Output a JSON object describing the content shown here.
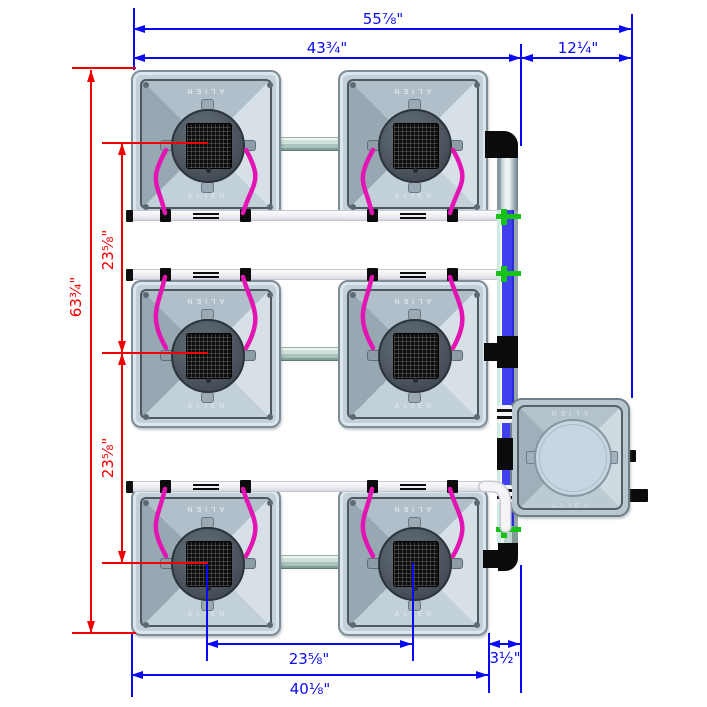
{
  "labels": {
    "brand": "ALIEN"
  },
  "colors": {
    "dimension_blue": "#0a0af2",
    "dimension_red": "#f20000",
    "hose_magenta": "#e215b2",
    "pipe_water_blue": "#4040f0",
    "fitting_green": "#17c317",
    "pipe_white": "#f4f4f7",
    "bucket_body": "#c2d0d9"
  },
  "buckets": [
    {
      "id": 1,
      "x": 131,
      "y": 70,
      "hose_dir": "down",
      "hose_pipe_y": 213
    },
    {
      "id": 2,
      "x": 338,
      "y": 70,
      "hose_dir": "down",
      "hose_pipe_y": 213
    },
    {
      "id": 3,
      "x": 131,
      "y": 280,
      "hose_dir": "up",
      "hose_pipe_y": 277
    },
    {
      "id": 4,
      "x": 338,
      "y": 280,
      "hose_dir": "up",
      "hose_pipe_y": 277
    },
    {
      "id": 5,
      "x": 131,
      "y": 488,
      "hose_dir": "up",
      "hose_pipe_y": 489
    },
    {
      "id": 6,
      "x": 338,
      "y": 488,
      "hose_dir": "up",
      "hose_pipe_y": 489
    }
  ],
  "connectors": [
    {
      "x": 275,
      "y": 137
    },
    {
      "x": 275,
      "y": 347
    },
    {
      "x": 275,
      "y": 555
    }
  ],
  "white_pipes": [
    {
      "y": 210,
      "x1": 127,
      "x2": 505,
      "centers": [
        206,
        413
      ],
      "curve": false
    },
    {
      "y": 269,
      "x1": 127,
      "x2": 505,
      "centers": [
        206,
        413
      ],
      "curve": false
    },
    {
      "y": 481,
      "x1": 127,
      "x2": 486,
      "centers": [
        206,
        413
      ],
      "curve": true
    }
  ],
  "curve_path": "M 484 486.5 L 492 486.5 Q 505.5 487 505.5 504 L 505.5 527",
  "manifold": [
    {
      "t": "steel",
      "r": [
        497,
        151,
        21,
        61
      ]
    },
    {
      "t": "blue",
      "r": [
        497,
        210,
        21,
        318
      ]
    },
    {
      "t": "teal",
      "r": [
        497,
        526,
        21,
        19
      ]
    },
    {
      "t": "elbow-tr",
      "r": [
        485,
        131,
        33,
        27
      ]
    },
    {
      "t": "tee",
      "r": [
        496,
        209,
        25,
        16
      ]
    },
    {
      "t": "tee",
      "r": [
        496,
        266,
        25,
        16
      ]
    },
    {
      "t": "tee",
      "r": [
        496,
        522,
        25,
        16
      ]
    },
    {
      "t": "black",
      "r": [
        497,
        336,
        21,
        32
      ]
    },
    {
      "t": "nub",
      "r": [
        484,
        343,
        14,
        18
      ]
    },
    {
      "t": "union",
      "r": [
        497,
        405,
        15,
        18
      ]
    },
    {
      "t": "black",
      "r": [
        497,
        438,
        16,
        32
      ]
    },
    {
      "t": "union",
      "r": [
        497,
        485,
        15,
        18
      ]
    },
    {
      "t": "elbow-br",
      "r": [
        498,
        543,
        20,
        28
      ]
    },
    {
      "t": "arm",
      "r": [
        483,
        550,
        22,
        18
      ]
    }
  ],
  "reservoir_fittings": [
    {
      "r": [
        627,
        450,
        9,
        12
      ]
    },
    {
      "r": [
        627,
        489,
        21,
        13
      ]
    }
  ],
  "dims_h": [
    {
      "label": "55⅞\"",
      "x1": 133,
      "x2": 631,
      "y": 29,
      "lx": 383,
      "ly": 19,
      "c": "blue"
    },
    {
      "label": "43¾\"",
      "x1": 133,
      "x2": 521,
      "y": 58,
      "lx": 327,
      "ly": 48,
      "c": "blue"
    },
    {
      "label": "12¼\"",
      "x1": 521,
      "x2": 631,
      "y": 58,
      "lx": 578,
      "ly": 48,
      "c": "blue"
    },
    {
      "label": "23⅝\"",
      "x1": 206,
      "x2": 412,
      "y": 644,
      "lx": 309,
      "ly": 659,
      "c": "blue"
    },
    {
      "label": "3½\"",
      "x1": 488,
      "x2": 520,
      "y": 644,
      "lx": 505,
      "ly": 658,
      "c": "blue"
    },
    {
      "label": "40⅛\"",
      "x1": 131,
      "x2": 488,
      "y": 675,
      "lx": 310,
      "ly": 689,
      "c": "blue"
    }
  ],
  "dims_v": [
    {
      "label": "63¾\"",
      "x": 91,
      "y1": 70,
      "y2": 633,
      "lx": 76,
      "ly": 297,
      "c": "red"
    },
    {
      "label": "23⅝\"",
      "x": 122,
      "y1": 143,
      "y2": 353,
      "lx": 108,
      "ly": 250,
      "c": "red"
    },
    {
      "label": "23⅝\"",
      "x": 122,
      "y1": 353,
      "y2": 563,
      "lx": 108,
      "ly": 458,
      "c": "red"
    }
  ],
  "ext_v": [
    {
      "x": 133,
      "y1": 8,
      "y2": 70,
      "c": "blue"
    },
    {
      "x": 631,
      "y1": 14,
      "y2": 398,
      "c": "blue"
    },
    {
      "x": 520,
      "y1": 44,
      "y2": 146,
      "c": "blue"
    },
    {
      "x": 520,
      "y1": 565,
      "y2": 693,
      "c": "blue"
    },
    {
      "x": 488,
      "y1": 633,
      "y2": 693,
      "c": "blue"
    },
    {
      "x": 131,
      "y1": 634,
      "y2": 697,
      "c": "blue"
    },
    {
      "x": 206,
      "y1": 563,
      "y2": 661,
      "c": "blue"
    },
    {
      "x": 412,
      "y1": 563,
      "y2": 661,
      "c": "blue"
    }
  ],
  "ext_h": [
    {
      "x1": 72,
      "x2": 136,
      "y": 68,
      "c": "red"
    },
    {
      "x1": 72,
      "x2": 136,
      "y": 633,
      "c": "red"
    },
    {
      "x1": 102,
      "x2": 208,
      "y": 143,
      "c": "red"
    },
    {
      "x1": 102,
      "x2": 208,
      "y": 353,
      "c": "red"
    },
    {
      "x1": 102,
      "x2": 208,
      "y": 563,
      "c": "red"
    }
  ]
}
